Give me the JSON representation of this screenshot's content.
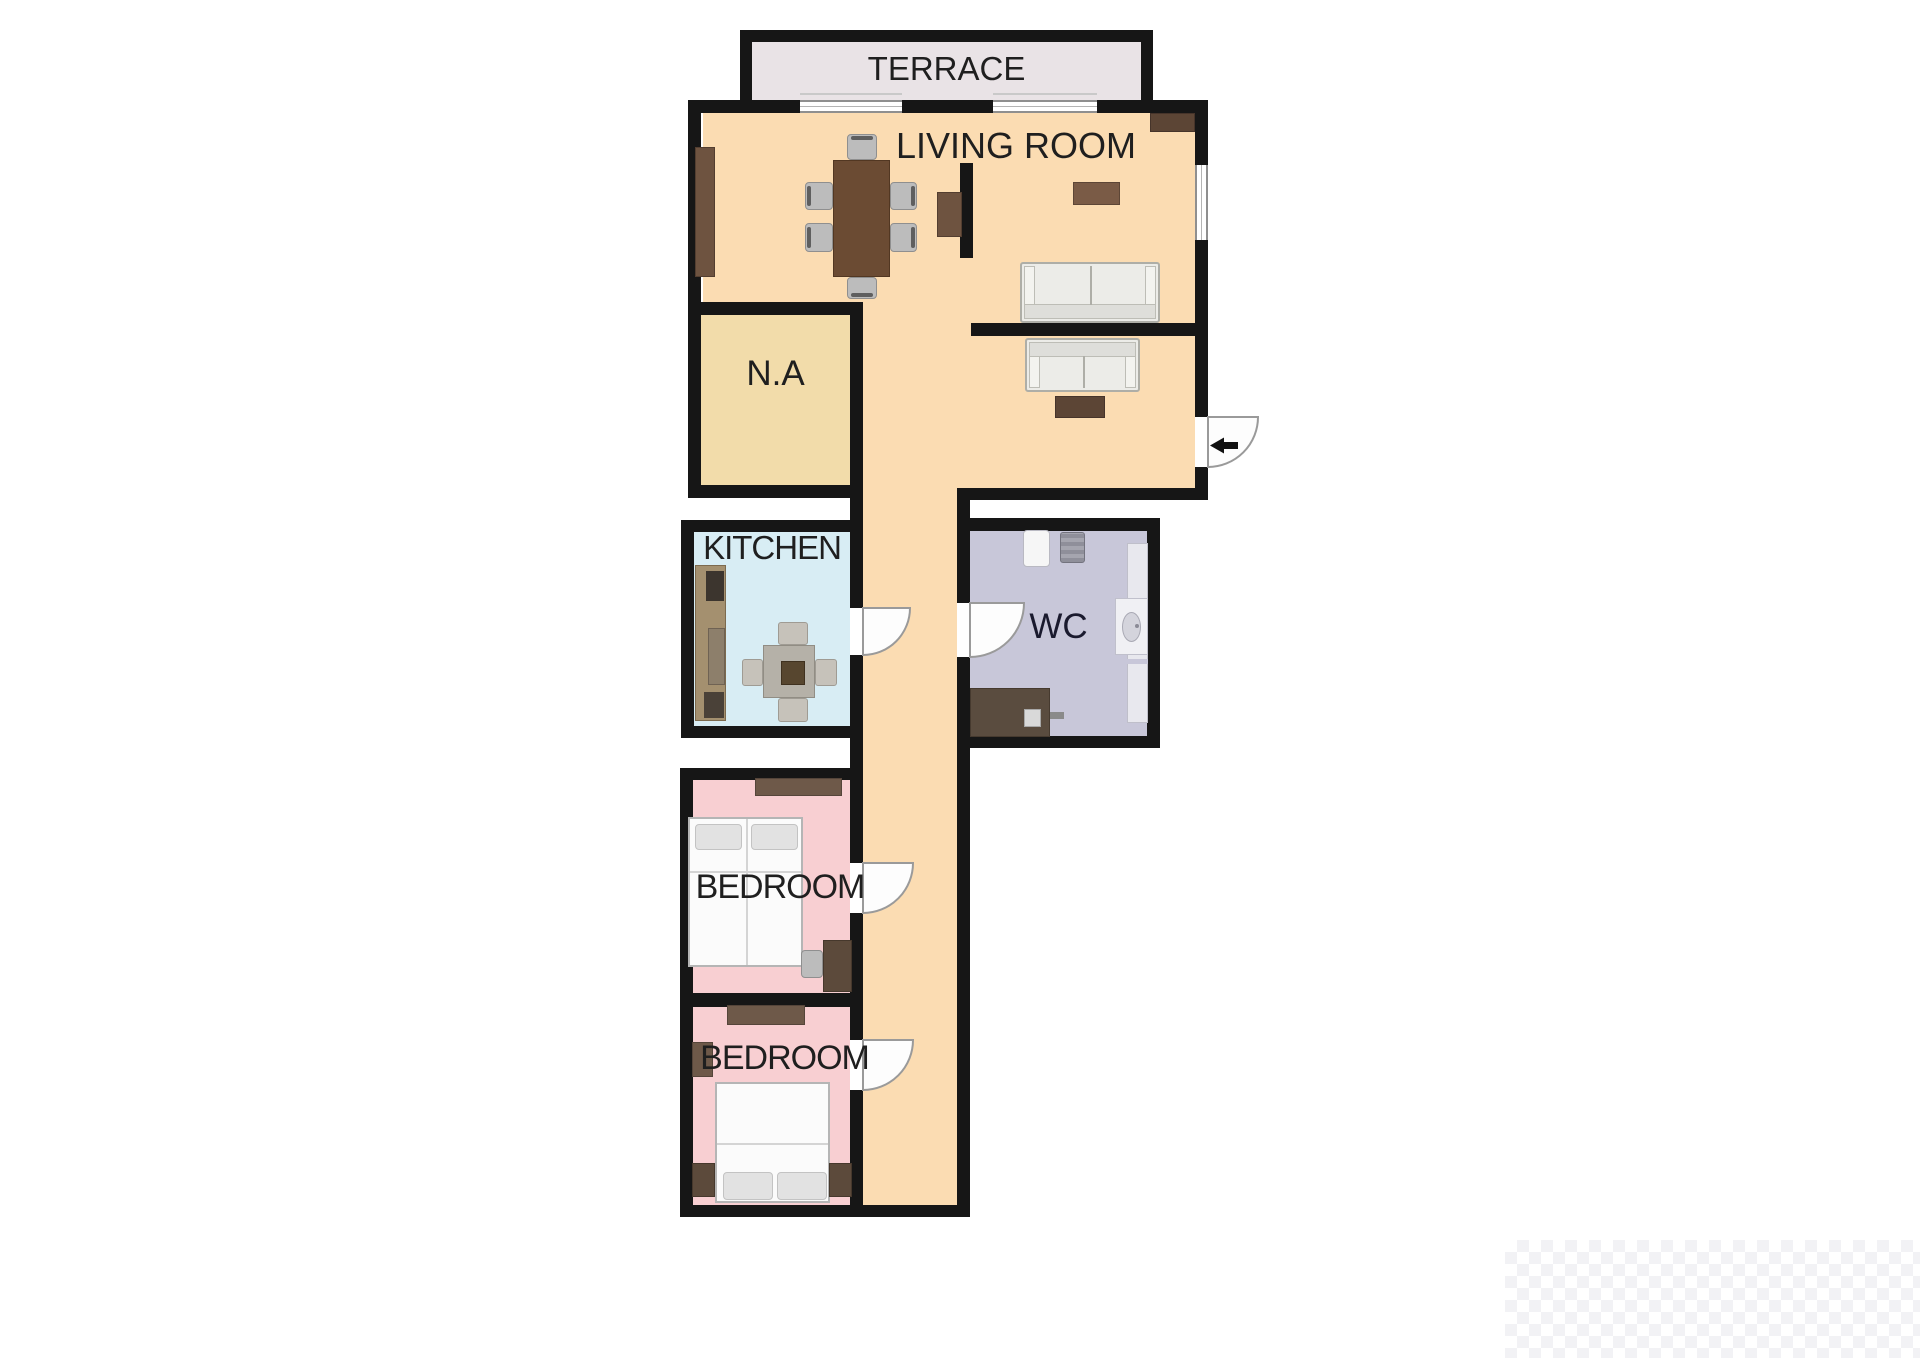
{
  "plan": {
    "type": "apartment-floor-plan",
    "background_color": "#ffffff",
    "wall_color": "#161616",
    "rooms": {
      "terrace": {
        "label": "TERRACE",
        "fill": "#e9e3e6"
      },
      "living_room": {
        "label": "LIVING ROOM",
        "fill": "#fbdcb2"
      },
      "corridor": {
        "label": "",
        "fill": "#fbdcb2"
      },
      "na": {
        "label": "N.A",
        "fill": "#f2dcaa"
      },
      "kitchen": {
        "label": "KITCHEN",
        "fill": "#d8edf4"
      },
      "wc": {
        "label": "WC",
        "fill": "#c8c7d9"
      },
      "bedroom1": {
        "label": "BEDROOM",
        "fill": "#f8cfd2"
      },
      "bedroom2": {
        "label": "BEDROOM",
        "fill": "#f8cfd2"
      }
    },
    "doors": [
      {
        "name": "entry-door",
        "location": "living room right wall",
        "swing": "outward",
        "arrow": "left"
      },
      {
        "name": "kitchen-door",
        "location": "kitchen right wall",
        "swing": "into corridor"
      },
      {
        "name": "wc-door",
        "location": "wc left wall",
        "swing": "into wc"
      },
      {
        "name": "bedroom1-door",
        "location": "bedroom1 right wall",
        "swing": "into corridor"
      },
      {
        "name": "bedroom2-door",
        "location": "bedroom2 right wall",
        "swing": "into corridor"
      }
    ],
    "furniture": [
      "sideboard",
      "dining-table",
      "dining-chair x6",
      "tv-unit",
      "partition-wall",
      "wall-shelf",
      "corner-cabinet",
      "sofa x2",
      "coffee-table",
      "kitchen-counter",
      "kitchen-table",
      "kitchen-chair x4",
      "washing-machine",
      "wc-appliance",
      "bathroom-counter",
      "sink",
      "vanity",
      "bedroom-shelf x2",
      "double-bed x2",
      "nightstand x3",
      "wardrobe",
      "bedroom-chair"
    ],
    "entry_arrow_color": "#111111",
    "text_color": "#1f1f1f"
  }
}
